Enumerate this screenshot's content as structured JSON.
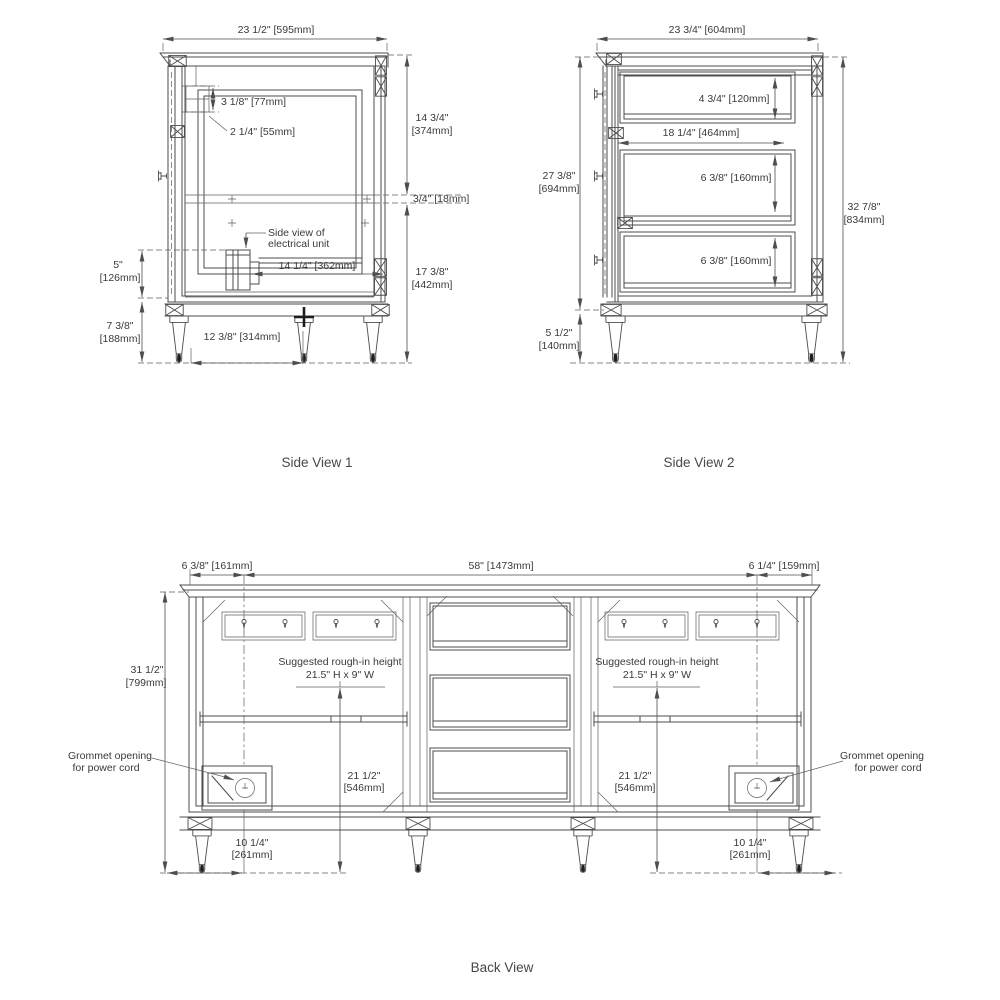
{
  "side1": {
    "label": "Side View 1",
    "width_top": "23 1/2\" [595mm]",
    "cleat_height": "3 1/8\" [77mm]",
    "cleat_offset": "2 1/4\" [55mm]",
    "upper_height_in": "14 3/4\"",
    "upper_height_mm": "[374mm]",
    "stretcher_thickness": "3/4\" [18mm]",
    "lower_height_in": "17 3/8\"",
    "lower_height_mm": "[442mm]",
    "electrical_note_line1": "Side view of",
    "electrical_note_line2": "electrical unit",
    "electrical_width": "14 1/4\" [362mm]",
    "toe_space_in": "5\"",
    "toe_space_mm": "[126mm]",
    "leg_height_in": "7 3/8\"",
    "leg_height_mm": "[188mm]",
    "leg_spacing": "12 3/8\" [314mm]"
  },
  "side2": {
    "label": "Side View 2",
    "width_top": "23 3/4\" [604mm]",
    "drawer1_height": "4 3/4\" [120mm]",
    "opening_width": "18 1/4\" [464mm]",
    "drawer2_height": "6 3/8\" [160mm]",
    "drawer3_height": "6 3/8\" [160mm]",
    "cabinet_height_in": "27 3/8\"",
    "cabinet_height_mm": "[694mm]",
    "leg_height_in": "5 1/2\"",
    "leg_height_mm": "[140mm]",
    "overall_height_in": "32 7/8\"",
    "overall_height_mm": "[834mm]"
  },
  "back": {
    "label": "Back View",
    "left_offset": "6 3/8\" [161mm]",
    "center_width": "58\" [1473mm]",
    "right_offset": "6 1/4\" [159mm]",
    "overall_height_in": "31 1/2\"",
    "overall_height_mm": "[799mm]",
    "roughin_note_line1": "Suggested rough-in height",
    "roughin_note_line2": "21.5\" H x 9\" W",
    "roughin_height_in": "21 1/2\"",
    "roughin_height_mm": "[546mm]",
    "grommet_note_line1": "Grommet opening",
    "grommet_note_line2": "for power cord",
    "grommet_offset_in": "10 1/4\"",
    "grommet_offset_mm": "[261mm]"
  }
}
